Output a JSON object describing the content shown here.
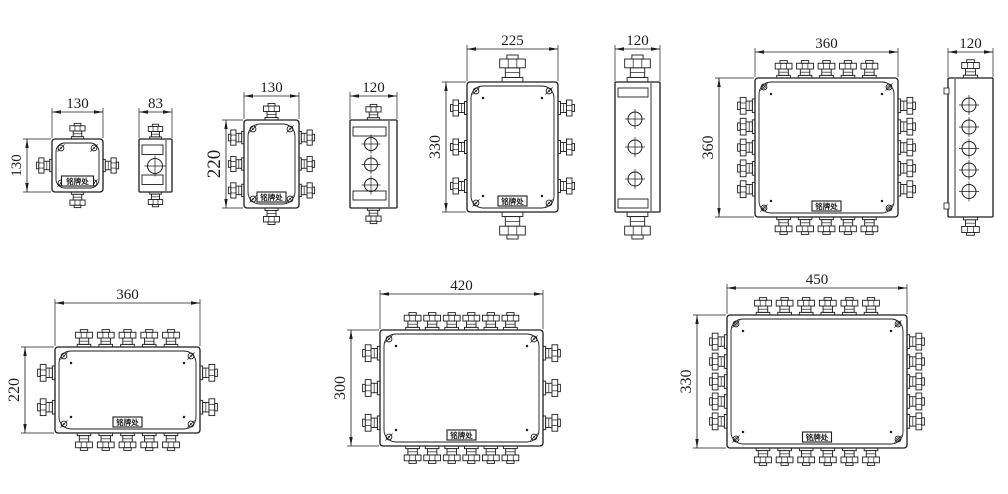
{
  "drawing": {
    "title": "junction-box-dimension-drawings",
    "background": "#ffffff",
    "ink": "#1c1c1c",
    "nameplate_text": "铭牌处",
    "canvas": {
      "w": 1008,
      "h": 494
    },
    "dimension_labels": [
      "130",
      "83",
      "130",
      "120",
      "225",
      "120",
      "360",
      "120",
      "360",
      "420",
      "450",
      "130",
      "220",
      "330",
      "360",
      "220",
      "300",
      "330"
    ],
    "figures": [
      {
        "id": "box-130x130-front",
        "kind": "front",
        "body": {
          "x": 52,
          "y": 139,
          "w": 51,
          "h": 53
        },
        "glands": {
          "top": 1,
          "bottom": 1,
          "left": 1,
          "right": 1
        },
        "gs_tb": 0.95,
        "gs_lr": 0.95,
        "nameplate": true,
        "plate_w": 32,
        "corner_style": "single",
        "dims": [
          {
            "axis": "h",
            "label": "130",
            "x1": 52,
            "x2": 103,
            "y": 112
          },
          {
            "axis": "v",
            "label": "130",
            "x": 27,
            "y1": 139,
            "y2": 192
          }
        ]
      },
      {
        "id": "box-83-side",
        "kind": "side",
        "body": {
          "x": 139,
          "y": 139,
          "w": 33,
          "h": 53
        },
        "glands": {
          "top": 1,
          "bottom": 1
        },
        "gs_tb": 0.9,
        "lid_x": 166,
        "bands": {
          "ys": [
            145,
            175
          ],
          "h": 9.5
        },
        "circles": {
          "cx": 155,
          "r": 7.5,
          "cys": [
            166
          ]
        },
        "dims": [
          {
            "axis": "h",
            "label": "83",
            "x1": 139,
            "x2": 172,
            "y": 112
          }
        ]
      },
      {
        "id": "box-130x220-front",
        "kind": "front",
        "body": {
          "x": 244,
          "y": 120,
          "w": 55,
          "h": 88
        },
        "glands": {
          "top": 1,
          "bottom": 1,
          "left": 3,
          "right": 3
        },
        "gs_tb": 1.0,
        "gs_lr": 0.95,
        "nameplate": true,
        "corner_style": "single",
        "dims": [
          {
            "axis": "h",
            "label": "130",
            "x1": 244,
            "x2": 299,
            "y": 96
          },
          {
            "axis": "v",
            "label": "220",
            "x": 226,
            "y1": 120,
            "y2": 208,
            "fs": 19
          }
        ]
      },
      {
        "id": "box-120-side-3bolt",
        "kind": "side",
        "body": {
          "x": 350,
          "y": 120,
          "w": 47,
          "h": 88
        },
        "glands": {
          "top": 1,
          "bottom": 1
        },
        "gs_tb": 0.95,
        "lid_x": 389,
        "bands": {
          "ys": [
            127,
            191
          ],
          "h": 9
        },
        "circles": {
          "cx": 371,
          "r": 6.5,
          "cys": [
            144,
            164.5,
            185
          ]
        },
        "dims": [
          {
            "axis": "h",
            "label": "120",
            "x1": 350,
            "x2": 397,
            "y": 96
          }
        ]
      },
      {
        "id": "box-225x330-front",
        "kind": "front",
        "body": {
          "x": 467,
          "y": 82,
          "w": 91,
          "h": 130
        },
        "glands": {
          "top": 1,
          "bottom": 1,
          "left": 3,
          "right": 3
        },
        "gs_tb": 1.6,
        "gs_lr": 1.0,
        "nameplate": true,
        "corner_style": "single",
        "dims": [
          {
            "axis": "h",
            "label": "225",
            "x1": 467,
            "x2": 558,
            "y": 49
          },
          {
            "axis": "v",
            "label": "330",
            "x": 446,
            "y1": 82,
            "y2": 212,
            "fs": 16
          }
        ]
      },
      {
        "id": "box-120-side-large-gland",
        "kind": "side",
        "body": {
          "x": 615,
          "y": 82,
          "w": 45,
          "h": 130
        },
        "glands": {
          "top": 1,
          "bottom": 1
        },
        "gs_tb": 1.6,
        "lid_x": 651,
        "bands": {
          "ys": [
            88,
            199
          ],
          "h": 9
        },
        "circles": {
          "cx": 635,
          "r": 7,
          "cys": [
            119,
            147,
            179
          ]
        },
        "dims": [
          {
            "axis": "h",
            "label": "120",
            "x1": 615,
            "x2": 660,
            "y": 49
          }
        ]
      },
      {
        "id": "box-360x360-front",
        "kind": "front",
        "body": {
          "x": 755,
          "y": 78,
          "w": 143,
          "h": 139
        },
        "glands": {
          "top": 5,
          "bottom": 5,
          "left": 5,
          "right": 5
        },
        "gs_tb": 1.05,
        "gs_lr": 1.05,
        "nameplate": true,
        "corner_style": "double",
        "dims": [
          {
            "axis": "h",
            "label": "360",
            "x1": 755,
            "x2": 898,
            "y": 52
          },
          {
            "axis": "v",
            "label": "360",
            "x": 719,
            "y1": 78,
            "y2": 217,
            "fs": 16
          }
        ]
      },
      {
        "id": "box-120-side-5bolt",
        "kind": "side",
        "body": {
          "x": 948,
          "y": 78,
          "w": 45,
          "h": 139
        },
        "glands": {
          "top": 1,
          "bottom": 1
        },
        "gs_tb": 1.1,
        "lid_x": 955,
        "circles": {
          "cx": 969,
          "r": 7,
          "cys": [
            105,
            127,
            148.5,
            170,
            191.5
          ]
        },
        "tabs": {
          "ys": [
            88,
            203
          ]
        },
        "dims": [
          {
            "axis": "h",
            "label": "120",
            "x1": 948,
            "x2": 993,
            "y": 52
          }
        ]
      },
      {
        "id": "box-360x220-front",
        "kind": "front",
        "body": {
          "x": 55,
          "y": 347,
          "w": 145,
          "h": 86
        },
        "glands": {
          "top": 5,
          "bottom": 5,
          "left": 2,
          "right": 2
        },
        "gs_tb": 1.05,
        "gs_lr": 1.05,
        "nameplate": true,
        "corner_style": "single",
        "dims": [
          {
            "axis": "h",
            "label": "360",
            "x1": 55,
            "x2": 200,
            "y": 303
          },
          {
            "axis": "v",
            "label": "220",
            "x": 25,
            "y1": 347,
            "y2": 433,
            "fs": 16
          }
        ]
      },
      {
        "id": "box-420x300-front",
        "kind": "front",
        "body": {
          "x": 380,
          "y": 330,
          "w": 163,
          "h": 116
        },
        "glands": {
          "top": 6,
          "bottom": 6,
          "left": 3,
          "right": 3
        },
        "gs_tb": 1.05,
        "gs_lr": 1.05,
        "nameplate": true,
        "corner_style": "single",
        "dims": [
          {
            "axis": "h",
            "label": "420",
            "x1": 380,
            "x2": 543,
            "y": 294
          },
          {
            "axis": "v",
            "label": "300",
            "x": 351,
            "y1": 330,
            "y2": 446,
            "fs": 16
          }
        ]
      },
      {
        "id": "box-450x330-front",
        "kind": "front",
        "body": {
          "x": 727,
          "y": 315,
          "w": 180,
          "h": 133
        },
        "glands": {
          "top": 6,
          "bottom": 6,
          "left": 5,
          "right": 5
        },
        "gs_tb": 1.05,
        "gs_lr": 1.05,
        "nameplate": true,
        "corner_style": "double",
        "dims": [
          {
            "axis": "h",
            "label": "450",
            "x1": 727,
            "x2": 907,
            "y": 288
          },
          {
            "axis": "v",
            "label": "330",
            "x": 697,
            "y1": 315,
            "y2": 448,
            "fs": 16
          }
        ]
      }
    ]
  }
}
